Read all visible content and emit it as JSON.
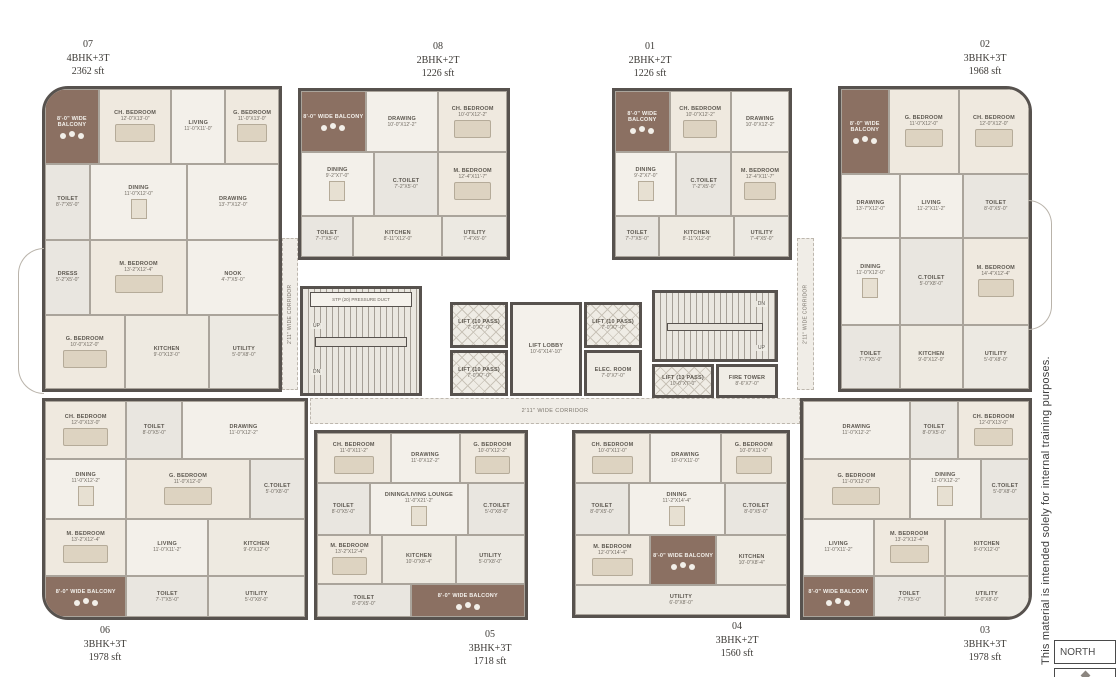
{
  "units": [
    {
      "id": "07",
      "type": "4BHK+3T",
      "area": "2362 sft",
      "rooms": [
        {
          "name": "8'-0\" WIDE BALCONY",
          "dim": "",
          "kind": "balcony",
          "w": "22%"
        },
        {
          "name": "CH. BEDROOM",
          "dim": "12'-0\"X13'-0\"",
          "kind": "bedroom",
          "w": "30%"
        },
        {
          "name": "LIVING",
          "dim": "11'-0\"X11'-0\"",
          "kind": "living",
          "w": "22%"
        },
        {
          "name": "G. BEDROOM",
          "dim": "11'-0\"X13'-0\"",
          "kind": "bedroom",
          "w": "22%"
        },
        {
          "name": "TOILET",
          "dim": "8'-7\"X5'-0\"",
          "kind": "toilet",
          "w": "18%"
        },
        {
          "name": "DINING",
          "dim": "11'-0\"X12'-0\"",
          "kind": "dining",
          "w": "40%"
        },
        {
          "name": "DRAWING",
          "dim": "13'-7\"X12'-0\"",
          "kind": "living",
          "w": "38%"
        },
        {
          "name": "DRESS",
          "dim": "5'-2\"X5'-0\"",
          "kind": "toilet",
          "w": "18%"
        },
        {
          "name": "M. BEDROOM",
          "dim": "13'-2\"X12'-4\"",
          "kind": "bedroom",
          "w": "40%"
        },
        {
          "name": "NOOK",
          "dim": "4'-7\"X5'-0\"",
          "kind": "living",
          "w": "38%"
        },
        {
          "name": "G. BEDROOM",
          "dim": "10'-0\"X12'-0\"",
          "kind": "bedroom",
          "w": "32%"
        },
        {
          "name": "KITCHEN",
          "dim": "9'-0\"X13'-0\"",
          "kind": "kitchen",
          "w": "34%"
        },
        {
          "name": "UTILITY",
          "dim": "5'-0\"X8'-0\"",
          "kind": "utility",
          "w": "28%"
        }
      ]
    },
    {
      "id": "08",
      "type": "2BHK+2T",
      "area": "1226 sft",
      "rooms": [
        {
          "name": "8'-0\" WIDE BALCONY",
          "dim": "",
          "kind": "balcony",
          "w": "30%"
        },
        {
          "name": "DRAWING",
          "dim": "10'-0\"X12'-2\"",
          "kind": "living",
          "w": "34%"
        },
        {
          "name": "CH. BEDROOM",
          "dim": "10'-0\"X12'-2\"",
          "kind": "bedroom",
          "w": "32%"
        },
        {
          "name": "DINING",
          "dim": "9'-2\"X7'-0\"",
          "kind": "dining",
          "w": "34%"
        },
        {
          "name": "C.TOILET",
          "dim": "7'-2\"X5'-0\"",
          "kind": "toilet",
          "w": "30%"
        },
        {
          "name": "M. BEDROOM",
          "dim": "12'-4\"X11'-7\"",
          "kind": "bedroom",
          "w": "32%"
        },
        {
          "name": "TOILET",
          "dim": "7'-7\"X5'-0\"",
          "kind": "toilet",
          "w": "24%"
        },
        {
          "name": "KITCHEN",
          "dim": "8'-11\"X12'-0\"",
          "kind": "kitchen",
          "w": "42%"
        },
        {
          "name": "UTILITY",
          "dim": "7'-4\"X5'-0\"",
          "kind": "utility",
          "w": "30%"
        }
      ]
    },
    {
      "id": "01",
      "type": "2BHK+2T",
      "area": "1226 sft",
      "rooms": [
        {
          "name": "8'-0\" WIDE BALCONY",
          "dim": "",
          "kind": "balcony",
          "w": "30%"
        },
        {
          "name": "CH. BEDROOM",
          "dim": "10'-0\"X12'-2\"",
          "kind": "bedroom",
          "w": "34%"
        },
        {
          "name": "DRAWING",
          "dim": "10'-0\"X12'-2\"",
          "kind": "living",
          "w": "32%"
        },
        {
          "name": "DINING",
          "dim": "9'-2\"X7'-0\"",
          "kind": "dining",
          "w": "34%"
        },
        {
          "name": "C.TOILET",
          "dim": "7'-2\"X5'-0\"",
          "kind": "toilet",
          "w": "30%"
        },
        {
          "name": "M. BEDROOM",
          "dim": "12'-4\"X11'-7\"",
          "kind": "bedroom",
          "w": "32%"
        },
        {
          "name": "TOILET",
          "dim": "7'-7\"X5'-0\"",
          "kind": "toilet",
          "w": "24%"
        },
        {
          "name": "KITCHEN",
          "dim": "8'-11\"X12'-0\"",
          "kind": "kitchen",
          "w": "42%"
        },
        {
          "name": "UTILITY",
          "dim": "7'-4\"X5'-0\"",
          "kind": "utility",
          "w": "30%"
        }
      ]
    },
    {
      "id": "02",
      "type": "3BHK+3T",
      "area": "1968 sft",
      "rooms": [
        {
          "name": "8'-0\" WIDE BALCONY",
          "dim": "",
          "kind": "balcony",
          "w": "24%"
        },
        {
          "name": "G. BEDROOM",
          "dim": "11'-0\"X12'-0\"",
          "kind": "bedroom",
          "w": "36%"
        },
        {
          "name": "CH. BEDROOM",
          "dim": "12'-0\"X12'-0\"",
          "kind": "bedroom",
          "w": "36%"
        },
        {
          "name": "DRAWING",
          "dim": "13'-7\"X12'-0\"",
          "kind": "living",
          "w": "30%"
        },
        {
          "name": "LIVING",
          "dim": "11'-2\"X11'-2\"",
          "kind": "living",
          "w": "32%"
        },
        {
          "name": "TOILET",
          "dim": "8'-0\"X5'-0\"",
          "kind": "toilet",
          "w": "34%"
        },
        {
          "name": "DINING",
          "dim": "11'-0\"X12'-0\"",
          "kind": "dining",
          "w": "30%"
        },
        {
          "name": "C.TOILET",
          "dim": "5'-0\"X8'-0\"",
          "kind": "toilet",
          "w": "32%"
        },
        {
          "name": "M. BEDROOM",
          "dim": "14'-4\"X12'-4\"",
          "kind": "bedroom",
          "w": "34%"
        },
        {
          "name": "TOILET",
          "dim": "7'-7\"X5'-0\"",
          "kind": "toilet",
          "w": "30%"
        },
        {
          "name": "KITCHEN",
          "dim": "9'-0\"X12'-0\"",
          "kind": "kitchen",
          "w": "32%"
        },
        {
          "name": "UTILITY",
          "dim": "5'-0\"X8'-0\"",
          "kind": "utility",
          "w": "34%"
        }
      ]
    },
    {
      "id": "06",
      "type": "3BHK+3T",
      "area": "1978 sft",
      "rooms": [
        {
          "name": "CH. BEDROOM",
          "dim": "12'-0\"X13'-0\"",
          "kind": "bedroom",
          "w": "30%"
        },
        {
          "name": "TOILET",
          "dim": "8'-0\"X5'-0\"",
          "kind": "toilet",
          "w": "20%"
        },
        {
          "name": "DRAWING",
          "dim": "11'-0\"X12'-2\"",
          "kind": "living",
          "w": "46%"
        },
        {
          "name": "DINING",
          "dim": "11'-0\"X12'-2\"",
          "kind": "dining",
          "w": "30%"
        },
        {
          "name": "G. BEDROOM",
          "dim": "11'-0\"X12'-0\"",
          "kind": "bedroom",
          "w": "46%"
        },
        {
          "name": "C.TOILET",
          "dim": "5'-0\"X8'-0\"",
          "kind": "toilet",
          "w": "20%"
        },
        {
          "name": "M. BEDROOM",
          "dim": "13'-2\"X12'-4\"",
          "kind": "bedroom",
          "w": "30%"
        },
        {
          "name": "LIVING",
          "dim": "11'-0\"X11'-2\"",
          "kind": "living",
          "w": "30%"
        },
        {
          "name": "KITCHEN",
          "dim": "9'-0\"X12'-0\"",
          "kind": "kitchen",
          "w": "36%"
        },
        {
          "name": "8'-0\" WIDE BALCONY",
          "dim": "",
          "kind": "balcony",
          "w": "30%"
        },
        {
          "name": "TOILET",
          "dim": "7'-7\"X5'-0\"",
          "kind": "toilet",
          "w": "30%"
        },
        {
          "name": "UTILITY",
          "dim": "5'-0\"X8'-0\"",
          "kind": "utility",
          "w": "36%"
        }
      ]
    },
    {
      "id": "05",
      "type": "3BHK+3T",
      "area": "1718 sft",
      "rooms": [
        {
          "name": "CH. BEDROOM",
          "dim": "11'-0\"X11'-2\"",
          "kind": "bedroom",
          "w": "34%"
        },
        {
          "name": "DRAWING",
          "dim": "11'-0\"X12'-2\"",
          "kind": "living",
          "w": "32%"
        },
        {
          "name": "G. BEDROOM",
          "dim": "10'-0\"X12'-2\"",
          "kind": "bedroom",
          "w": "30%"
        },
        {
          "name": "TOILET",
          "dim": "8'-0\"X5'-0\"",
          "kind": "toilet",
          "w": "24%"
        },
        {
          "name": "DINING/LIVING LOUNGE",
          "dim": "11'-0\"X21'-2\"",
          "kind": "dining",
          "w": "46%"
        },
        {
          "name": "C.TOILET",
          "dim": "5'-0\"X8'-0\"",
          "kind": "toilet",
          "w": "26%"
        },
        {
          "name": "M. BEDROOM",
          "dim": "13'-2\"X12'-4\"",
          "kind": "bedroom",
          "w": "30%"
        },
        {
          "name": "KITCHEN",
          "dim": "10'-0\"X8'-4\"",
          "kind": "kitchen",
          "w": "34%"
        },
        {
          "name": "UTILITY",
          "dim": "5'-0\"X8'-0\"",
          "kind": "utility",
          "w": "32%"
        },
        {
          "name": "TOILET",
          "dim": "8'-0\"X5'-0\"",
          "kind": "toilet",
          "w": "30%"
        },
        {
          "name": "8'-0\" WIDE BALCONY",
          "dim": "",
          "kind": "balcony",
          "w": "40%"
        }
      ]
    },
    {
      "id": "04",
      "type": "3BHK+2T",
      "area": "1560 sft",
      "rooms": [
        {
          "name": "CH. BEDROOM",
          "dim": "10'-0\"X11'-0\"",
          "kind": "bedroom",
          "w": "34%"
        },
        {
          "name": "DRAWING",
          "dim": "10'-0\"X11'-0\"",
          "kind": "living",
          "w": "32%"
        },
        {
          "name": "G. BEDROOM",
          "dim": "10'-0\"X11'-0\"",
          "kind": "bedroom",
          "w": "30%"
        },
        {
          "name": "TOILET",
          "dim": "8'-0\"X5'-0\"",
          "kind": "toilet",
          "w": "24%"
        },
        {
          "name": "DINING",
          "dim": "11'-2\"X14'-4\"",
          "kind": "dining",
          "w": "44%"
        },
        {
          "name": "C.TOILET",
          "dim": "8'-0\"X5'-0\"",
          "kind": "toilet",
          "w": "28%"
        },
        {
          "name": "M. BEDROOM",
          "dim": "12'-0\"X14'-4\"",
          "kind": "bedroom",
          "w": "34%"
        },
        {
          "name": "8'-0\" WIDE BALCONY",
          "dim": "",
          "kind": "balcony",
          "w": "30%"
        },
        {
          "name": "KITCHEN",
          "dim": "10'-0\"X8'-4\"",
          "kind": "kitchen",
          "w": "32%"
        },
        {
          "name": "UTILITY",
          "dim": "6'-0\"X8'-0\"",
          "kind": "utility",
          "w": "30%"
        }
      ]
    },
    {
      "id": "03",
      "type": "3BHK+3T",
      "area": "1978 sft",
      "rooms": [
        {
          "name": "DRAWING",
          "dim": "11'-0\"X12'-2\"",
          "kind": "living",
          "w": "46%"
        },
        {
          "name": "TOILET",
          "dim": "8'-0\"X5'-0\"",
          "kind": "toilet",
          "w": "20%"
        },
        {
          "name": "CH. BEDROOM",
          "dim": "12'-0\"X13'-0\"",
          "kind": "bedroom",
          "w": "30%"
        },
        {
          "name": "G. BEDROOM",
          "dim": "11'-0\"X12'-0\"",
          "kind": "bedroom",
          "w": "46%"
        },
        {
          "name": "DINING",
          "dim": "11'-0\"X12'-2\"",
          "kind": "dining",
          "w": "30%"
        },
        {
          "name": "C.TOILET",
          "dim": "5'-0\"X8'-0\"",
          "kind": "toilet",
          "w": "20%"
        },
        {
          "name": "LIVING",
          "dim": "11'-0\"X11'-2\"",
          "kind": "living",
          "w": "30%"
        },
        {
          "name": "M. BEDROOM",
          "dim": "13'-2\"X12'-4\"",
          "kind": "bedroom",
          "w": "30%"
        },
        {
          "name": "KITCHEN",
          "dim": "9'-0\"X12'-0\"",
          "kind": "kitchen",
          "w": "36%"
        },
        {
          "name": "8'-0\" WIDE BALCONY",
          "dim": "",
          "kind": "balcony",
          "w": "30%"
        },
        {
          "name": "TOILET",
          "dim": "7'-7\"X5'-0\"",
          "kind": "toilet",
          "w": "30%"
        },
        {
          "name": "UTILITY",
          "dim": "5'-0\"X8'-0\"",
          "kind": "utility",
          "w": "36%"
        }
      ]
    }
  ],
  "core": {
    "lift10_label": "LIFT (10 PASS)",
    "lift10_dim": "7'-0\"X7'-0\"",
    "lift13_label": "LIFT (13 PASS)",
    "lift13_dim": "10'-0\"X7'-0\"",
    "lobby_label": "LIFT LOBBY",
    "lobby_dim": "10'-6\"X14'-10\"",
    "elec_label": "ELEC. ROOM",
    "elec_dim": "7'-0\"X7'-0\"",
    "fire_label": "FIRE TOWER",
    "fire_dim": "8'-6\"X7'-0\"",
    "stair_up": "UP",
    "stair_dn": "DN",
    "duct_label": "STP (20) PRESSURE DUCT"
  },
  "corridors": {
    "h": "2'11\" WIDE CORRIDOR",
    "v_left": "2'11\" WIDE CORRIDOR",
    "v_right": "2'11\" WIDE CORRIDOR"
  },
  "notes": {
    "disclaimer": "This material is intended solely for internal training purposes.",
    "north": "NORTH"
  },
  "colors": {
    "wall": "#57524e",
    "floor": "#f3f0ea",
    "balcony": "#8b7062"
  }
}
